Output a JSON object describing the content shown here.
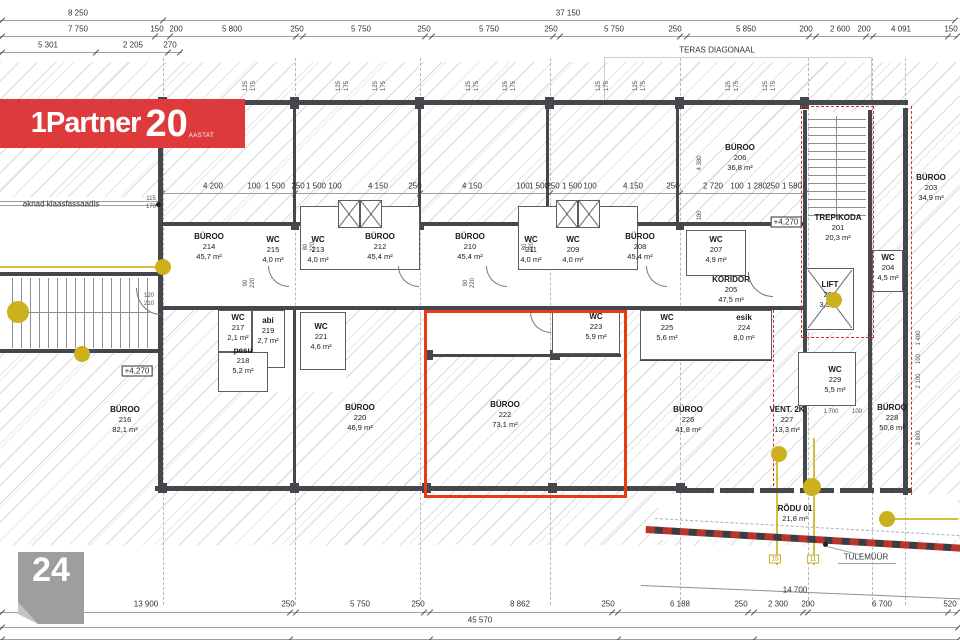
{
  "logo": {
    "brand": "1Partner",
    "num": "20",
    "sub": "AASTAT"
  },
  "badge": {
    "number": "24"
  },
  "colors": {
    "highlight_red": "#e73b12",
    "logo_red": "#de3a3c",
    "marker_yellow": "#ccb11d",
    "wall": "#44474b"
  },
  "dim_rows": [
    {
      "id": "top-row-1",
      "y": 13,
      "line_y": 20,
      "line_spans": [
        [
          0,
          163
        ],
        [
          163,
          955
        ]
      ],
      "ticks": [
        2,
        163,
        955
      ],
      "labels": [
        {
          "t": "8 250",
          "x": 78
        },
        {
          "t": "37 150",
          "x": 568
        }
      ]
    },
    {
      "id": "top-row-2",
      "y": 29,
      "line_y": 36,
      "line_spans": [
        [
          0,
          958
        ]
      ],
      "ticks": [
        2,
        155,
        170,
        296,
        303,
        425,
        432,
        553,
        560,
        680,
        687,
        809,
        816,
        866,
        873,
        948,
        957
      ],
      "labels": [
        {
          "t": "7 750",
          "x": 78
        },
        {
          "t": "150",
          "x": 157
        },
        {
          "t": "200",
          "x": 176
        },
        {
          "t": "5 800",
          "x": 232
        },
        {
          "t": "250",
          "x": 297
        },
        {
          "t": "5 750",
          "x": 361
        },
        {
          "t": "250",
          "x": 424
        },
        {
          "t": "5 750",
          "x": 489
        },
        {
          "t": "250",
          "x": 551
        },
        {
          "t": "5 750",
          "x": 614
        },
        {
          "t": "250",
          "x": 675
        },
        {
          "t": "5 850",
          "x": 746
        },
        {
          "t": "200",
          "x": 806
        },
        {
          "t": "2 600",
          "x": 840
        },
        {
          "t": "200",
          "x": 864
        },
        {
          "t": "4 091",
          "x": 901
        },
        {
          "t": "150",
          "x": 951
        }
      ]
    },
    {
      "id": "top-row-3",
      "y": 45,
      "line_y": 52,
      "line_spans": [
        [
          0,
          182
        ]
      ],
      "ticks": [
        2,
        96,
        168,
        180
      ],
      "labels": [
        {
          "t": "5 301",
          "x": 48
        },
        {
          "t": "2 205",
          "x": 133
        },
        {
          "t": "270",
          "x": 170
        }
      ]
    },
    {
      "id": "interior-row",
      "y": 186,
      "line_y": 193,
      "line_spans": [
        [
          162,
          805
        ]
      ],
      "ticks": [
        162,
        295,
        420,
        550,
        680,
        805
      ],
      "labels": [
        {
          "t": "4 200",
          "x": 213
        },
        {
          "t": "100",
          "x": 254
        },
        {
          "t": "1 500",
          "x": 275
        },
        {
          "t": "250",
          "x": 298
        },
        {
          "t": "1 500",
          "x": 316
        },
        {
          "t": "100",
          "x": 335
        },
        {
          "t": "4 150",
          "x": 378
        },
        {
          "t": "250",
          "x": 415
        },
        {
          "t": "4 150",
          "x": 472
        },
        {
          "t": "100",
          "x": 523
        },
        {
          "t": "1 500",
          "x": 539
        },
        {
          "t": "250",
          "x": 553
        },
        {
          "t": "1 500",
          "x": 572
        },
        {
          "t": "100",
          "x": 590
        },
        {
          "t": "4 150",
          "x": 633
        },
        {
          "t": "250",
          "x": 673
        },
        {
          "t": "2 720",
          "x": 713
        },
        {
          "t": "100",
          "x": 737
        },
        {
          "t": "1 280",
          "x": 757
        },
        {
          "t": "250",
          "x": 773
        },
        {
          "t": "1 580",
          "x": 792
        }
      ]
    },
    {
      "id": "bottom-row-1",
      "y": 604,
      "line_y": 612,
      "line_spans": [
        [
          0,
          958
        ]
      ],
      "ticks": [
        2,
        290,
        296,
        424,
        430,
        612,
        618,
        748,
        754,
        803,
        808,
        948,
        957
      ],
      "labels": [
        {
          "t": "13 900",
          "x": 146
        },
        {
          "t": "250",
          "x": 288
        },
        {
          "t": "5 750",
          "x": 360
        },
        {
          "t": "250",
          "x": 418
        },
        {
          "t": "8 862",
          "x": 520
        },
        {
          "t": "250",
          "x": 608
        },
        {
          "t": "6 188",
          "x": 680
        },
        {
          "t": "250",
          "x": 741
        },
        {
          "t": "2 300",
          "x": 778
        },
        {
          "t": "200",
          "x": 808
        },
        {
          "t": "6 700",
          "x": 882
        },
        {
          "t": "520",
          "x": 950
        }
      ]
    },
    {
      "id": "bottom-row-2",
      "y": 620,
      "line_y": 627,
      "line_spans": [
        [
          0,
          958
        ]
      ],
      "ticks": [
        2,
        958
      ],
      "labels": [
        {
          "t": "45 570",
          "x": 480
        }
      ]
    },
    {
      "id": "bottom-row-3",
      "y": 634,
      "line_y": 639,
      "line_spans": [
        [
          0,
          958
        ]
      ],
      "ticks": [
        2,
        290,
        430,
        618,
        754,
        958
      ],
      "labels": []
    }
  ],
  "window_ticks": {
    "pair": [
      "125",
      "175"
    ],
    "y": 86,
    "xs": [
      250,
      343,
      380,
      473,
      510,
      603,
      640,
      733,
      770
    ]
  },
  "small_dims": [
    {
      "t": "115",
      "x": 151,
      "y": 199
    },
    {
      "t": "170",
      "x": 151,
      "y": 207
    },
    {
      "t": "120",
      "x": 149,
      "y": 296
    },
    {
      "t": "210",
      "x": 149,
      "y": 304
    },
    {
      "t": "1 700",
      "x": 831,
      "y": 412
    },
    {
      "t": "100",
      "x": 857,
      "y": 412
    },
    {
      "t": "1 480",
      "x": 919,
      "y": 338,
      "rot": true
    },
    {
      "t": "100",
      "x": 919,
      "y": 359,
      "rot": true
    },
    {
      "t": "2 100",
      "x": 919,
      "y": 381,
      "rot": true
    },
    {
      "t": "3 800",
      "x": 919,
      "y": 438,
      "rot": true
    },
    {
      "t": "80",
      "x": 306,
      "y": 247,
      "rot": true
    },
    {
      "t": "220",
      "x": 313,
      "y": 247,
      "rot": true
    },
    {
      "t": "80",
      "x": 525,
      "y": 247,
      "rot": true
    },
    {
      "t": "220",
      "x": 532,
      "y": 247,
      "rot": true
    },
    {
      "t": "90",
      "x": 246,
      "y": 283,
      "rot": true
    },
    {
      "t": "220",
      "x": 253,
      "y": 283,
      "rot": true
    },
    {
      "t": "90",
      "x": 466,
      "y": 283,
      "rot": true
    },
    {
      "t": "220",
      "x": 473,
      "y": 283,
      "rot": true
    },
    {
      "t": "4 380",
      "x": 700,
      "y": 163,
      "rot": true
    },
    {
      "t": "1 180",
      "x": 700,
      "y": 218,
      "rot": true
    }
  ],
  "rooms": [
    {
      "n": "BÜROO",
      "num": "214",
      "a": "45,7 m²",
      "x": 209,
      "y": 247
    },
    {
      "n": "WC",
      "num": "215",
      "a": "4,0 m²",
      "x": 273,
      "y": 250
    },
    {
      "n": "WC",
      "num": "213",
      "a": "4,0 m²",
      "x": 318,
      "y": 250
    },
    {
      "n": "BÜROO",
      "num": "212",
      "a": "45,4 m²",
      "x": 380,
      "y": 247
    },
    {
      "n": "BÜROO",
      "num": "210",
      "a": "45,4 m²",
      "x": 470,
      "y": 247
    },
    {
      "n": "WC",
      "num": "211",
      "a": "4,0 m²",
      "x": 531,
      "y": 250
    },
    {
      "n": "WC",
      "num": "209",
      "a": "4,0 m²",
      "x": 573,
      "y": 250
    },
    {
      "n": "BÜROO",
      "num": "208",
      "a": "45,4 m²",
      "x": 640,
      "y": 247
    },
    {
      "n": "BÜROO",
      "num": "206",
      "a": "36,8 m²",
      "x": 740,
      "y": 158
    },
    {
      "n": "WC",
      "num": "207",
      "a": "4,9 m²",
      "x": 716,
      "y": 250
    },
    {
      "n": "KORIDOR",
      "num": "205",
      "a": "47,5 m²",
      "x": 731,
      "y": 290
    },
    {
      "n": "TREPIKODA",
      "num": "201",
      "a": "20,3 m²",
      "x": 838,
      "y": 228
    },
    {
      "n": "LIFT",
      "num": "202",
      "a": "3,3 m²",
      "x": 830,
      "y": 295
    },
    {
      "n": "WC",
      "num": "204",
      "a": "4,5 m²",
      "x": 888,
      "y": 268
    },
    {
      "n": "BÜROO",
      "num": "203",
      "a": "34,9 m²",
      "x": 931,
      "y": 188
    },
    {
      "n": "BÜROO",
      "num": "216",
      "a": "82,1 m²",
      "x": 125,
      "y": 420
    },
    {
      "n": "WC",
      "num": "217",
      "a": "2,1 m²",
      "x": 238,
      "y": 328
    },
    {
      "n": "abi",
      "num": "219",
      "a": "2,7 m²",
      "x": 268,
      "y": 331
    },
    {
      "n": "pesu",
      "num": "218",
      "a": "5,2 m²",
      "x": 243,
      "y": 361
    },
    {
      "n": "WC",
      "num": "221",
      "a": "4,6 m²",
      "x": 321,
      "y": 337
    },
    {
      "n": "BÜROO",
      "num": "220",
      "a": "46,9 m²",
      "x": 360,
      "y": 418
    },
    {
      "n": "BÜROO",
      "num": "222",
      "a": "73,1 m²",
      "x": 505,
      "y": 415
    },
    {
      "n": "WC",
      "num": "223",
      "a": "5,9 m²",
      "x": 596,
      "y": 327
    },
    {
      "n": "WC",
      "num": "225",
      "a": "5,6 m²",
      "x": 667,
      "y": 328
    },
    {
      "n": "esik",
      "num": "224",
      "a": "8,0 m²",
      "x": 744,
      "y": 328
    },
    {
      "n": "BÜROO",
      "num": "226",
      "a": "41,8 m²",
      "x": 688,
      "y": 420
    },
    {
      "n": "VENT. 2K",
      "num": "227",
      "a": "13,3 m²",
      "x": 787,
      "y": 420
    },
    {
      "n": "WC",
      "num": "229",
      "a": "5,5 m²",
      "x": 835,
      "y": 380
    },
    {
      "n": "BÜROO",
      "num": "228",
      "a": "50,8 m²",
      "x": 892,
      "y": 418
    },
    {
      "n": "RÕDU 01",
      "num": "",
      "a": "21,8 m²",
      "x": 795,
      "y": 514
    }
  ],
  "annotations": [
    {
      "t": "TERAS DIAGONAAL",
      "x": 717,
      "y": 50
    },
    {
      "t": "aknad klaasfassaadis",
      "x": 61,
      "y": 204
    },
    {
      "t": "+4,270",
      "x": 137,
      "y": 371,
      "boxed": true
    },
    {
      "t": "+4,270",
      "x": 786,
      "y": 222,
      "boxed": true
    },
    {
      "t": "TULEMÜÜR",
      "x": 866,
      "y": 557
    },
    {
      "t": "14 700",
      "x": 795,
      "y": 590
    }
  ],
  "yellow": {
    "dots": [
      [
        18,
        312,
        11
      ],
      [
        82,
        354,
        8
      ],
      [
        163,
        267,
        8
      ],
      [
        834,
        300,
        8
      ],
      [
        779,
        454,
        8
      ],
      [
        812,
        487,
        9
      ],
      [
        887,
        519,
        8
      ]
    ],
    "tags": [
      {
        "t": "15",
        "x": 775,
        "y": 559
      },
      {
        "t": "11",
        "x": 813,
        "y": 559
      }
    ]
  }
}
